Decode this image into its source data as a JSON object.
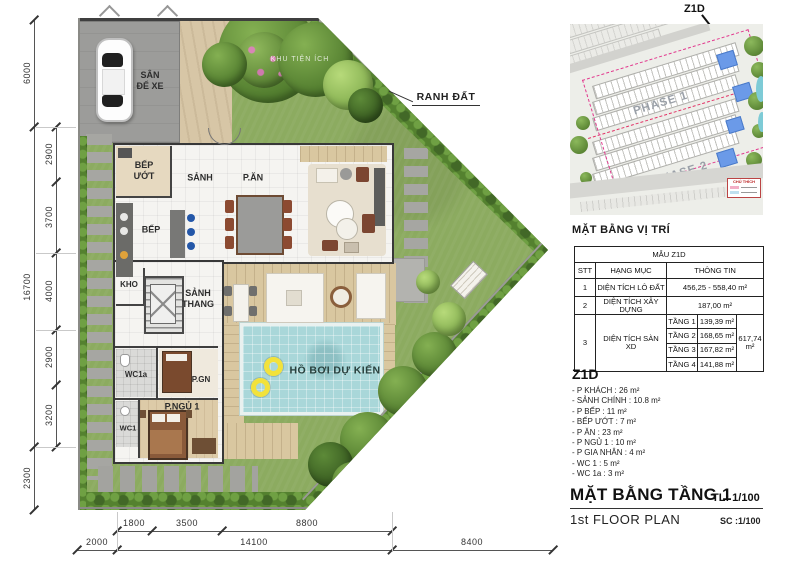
{
  "plan": {
    "rooms": {
      "garage": "SÂN\nĐỂ XE",
      "wet_kitchen": "BẾP\nƯỚT",
      "hall": "SẢNH",
      "dining": "P.ĂN",
      "living": "P.KHÁCH",
      "kitchen": "BẾP",
      "storage": "KHO",
      "stair_hall": "SẢNH\nTHANG",
      "wc1a": "WC1a",
      "maid_room": "P.GN",
      "bedroom1": "P.NGỦ 1",
      "wc1": "WC1",
      "pool": "HỒ BƠI DỰ KIẾN"
    },
    "labels": {
      "boundary": "RANH ĐẤT",
      "amenity": "KHU TIỆN ÍCH"
    },
    "dims": {
      "left_outer": [
        "6000",
        "16700",
        "2300"
      ],
      "left_inner": [
        "2900",
        "3700",
        "4000",
        "2900",
        "3200"
      ],
      "bottom_inner": [
        "1800",
        "3500",
        "8800"
      ],
      "bottom_outer": [
        "2000",
        "14100",
        "8400"
      ]
    }
  },
  "inset": {
    "callout": "Z1D",
    "phase1": "PHASE 1",
    "phase2": "PHASE 2",
    "legend_title": "CHÚ THÍCH",
    "caption": "MẶT BẰNG VỊ TRÍ"
  },
  "table": {
    "title": "MẪU Z1D",
    "headers": {
      "no": "STT",
      "item": "HẠNG MỤC",
      "info": "THÔNG TIN"
    },
    "rows": [
      {
        "no": "1",
        "item": "DIỆN TÍCH LÔ ĐẤT",
        "info": "456,25 - 558,40 m²"
      },
      {
        "no": "2",
        "item": "DIỆN TÍCH XÂY DỰNG",
        "info": "187,00 m²"
      },
      {
        "no": "3",
        "item": "DIỆN TÍCH SÀN XD",
        "floors": [
          {
            "label": "TẦNG 1",
            "value": "139,39 m²"
          },
          {
            "label": "TẦNG 2",
            "value": "168,65 m²"
          },
          {
            "label": "TẦNG 3",
            "value": "167,82 m²"
          },
          {
            "label": "TẦNG 4",
            "value": "141,88 m²"
          }
        ],
        "total": "617,74 m²"
      }
    ]
  },
  "legend": {
    "title": "Z1D",
    "items": [
      "- P KHÁCH : 26 m²",
      "- SẢNH CHÍNH : 10.8 m²",
      "- P BẾP : 11 m²",
      "- BẾP ƯỚT : 7 m²",
      "- P ĂN : 23 m²",
      "- P NGỦ 1 : 10 m²",
      "- P GIA NHÂN : 4 m²",
      "- WC 1 : 5 m²",
      "- WC 1a : 3 m²"
    ]
  },
  "titleblock": {
    "title_vi": "MẶT BẰNG TẦNG 1",
    "scale_vi": "TL: 1/100",
    "title_en": "1st FLOOR PLAN",
    "scale_en": "SC :1/100"
  },
  "colors": {
    "grass": "#8CAB60",
    "pool": "#A9D7D9",
    "deck": "#D9C7A0",
    "boundary_dash": "#E8386E",
    "water_lot": "#6B9AE8"
  }
}
